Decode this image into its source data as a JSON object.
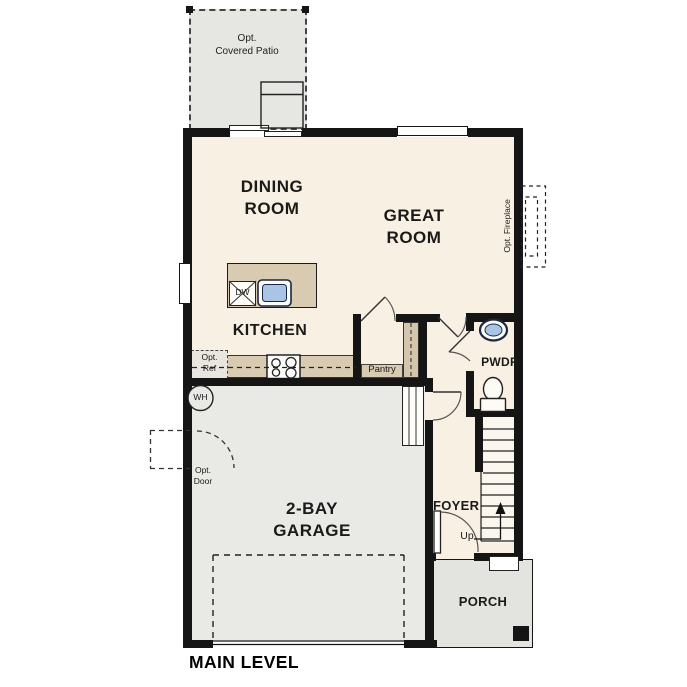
{
  "title": "MAIN LEVEL",
  "rooms": {
    "dining": "DINING\nROOM",
    "great": "GREAT\nROOM",
    "kitchen": "KITCHEN",
    "garage": "2-BAY\nGARAGE",
    "foyer": "FOYER",
    "porch": "PORCH",
    "powder": "PWDR",
    "pantry": "Pantry",
    "patio": "Opt.\nCovered Patio"
  },
  "annotations": {
    "opt_ref": "Opt.\nRef",
    "opt_door": "Opt.\nDoor",
    "opt_fireplace": "Opt. Fireplace",
    "water_heater": "WH",
    "dishwasher": "DW",
    "stairs_up": "Up"
  },
  "colors": {
    "wall": "#151515",
    "interior": "#f8f0e2",
    "garage": "#e9e9e6",
    "porch": "#e3e3e0",
    "patio": "#e6e6e3",
    "counter": "#d8cbb2",
    "fixture_blue": "#a9c4e4"
  }
}
